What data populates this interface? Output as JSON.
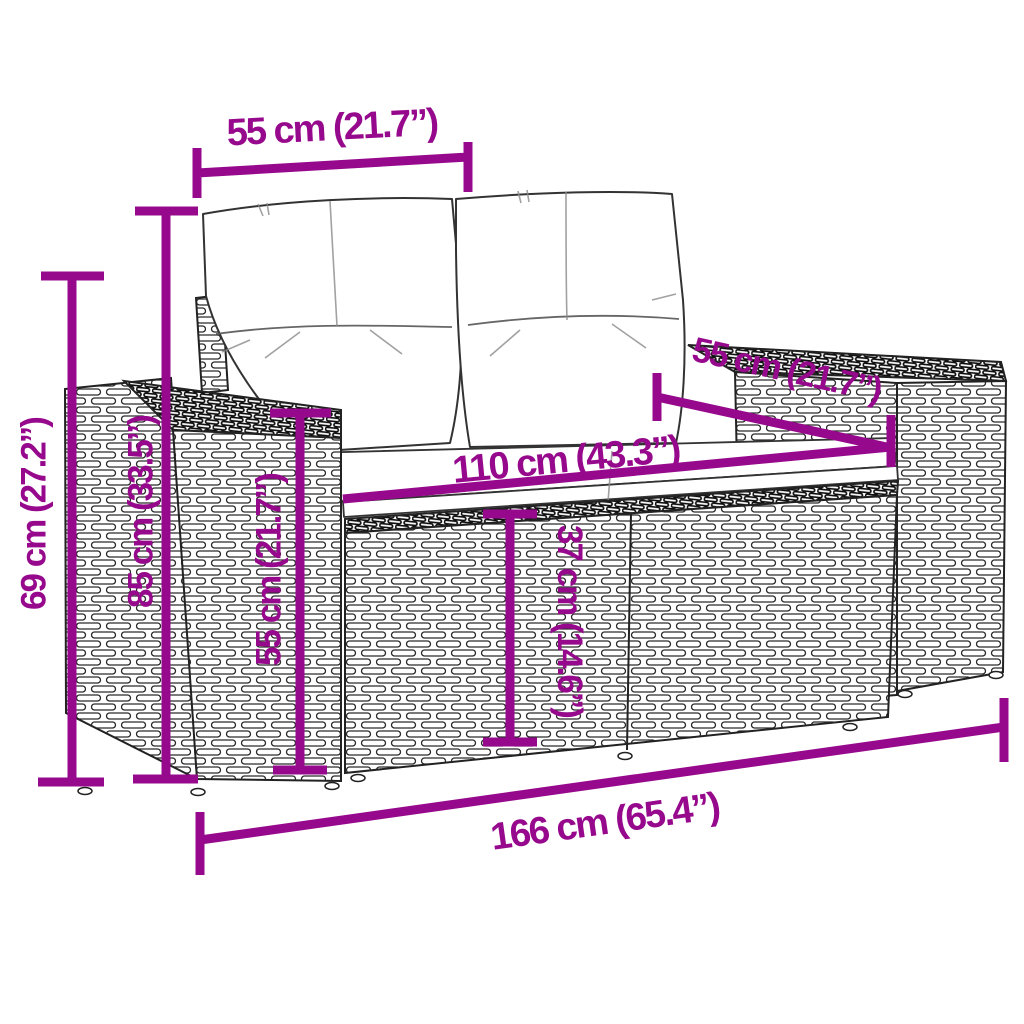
{
  "colors": {
    "dimension": "#97098C",
    "line": "#222222",
    "background": "#ffffff",
    "cushion": "#ffffff"
  },
  "dimensions": {
    "cushion_width": {
      "label": "55 cm (21.7”)"
    },
    "armrest_height": {
      "label": "69 cm (27.2”)"
    },
    "back_height": {
      "label": "85 cm (33.5”)"
    },
    "side_height": {
      "label": "55 cm (21.7”)"
    },
    "seat_depth": {
      "label": "55 cm (21.7”)"
    },
    "seat_width": {
      "label": "110 cm (43.3”)"
    },
    "seat_height": {
      "label": "37 cm (14.6”)"
    },
    "total_width": {
      "label": "166 cm (65.4”)"
    }
  }
}
